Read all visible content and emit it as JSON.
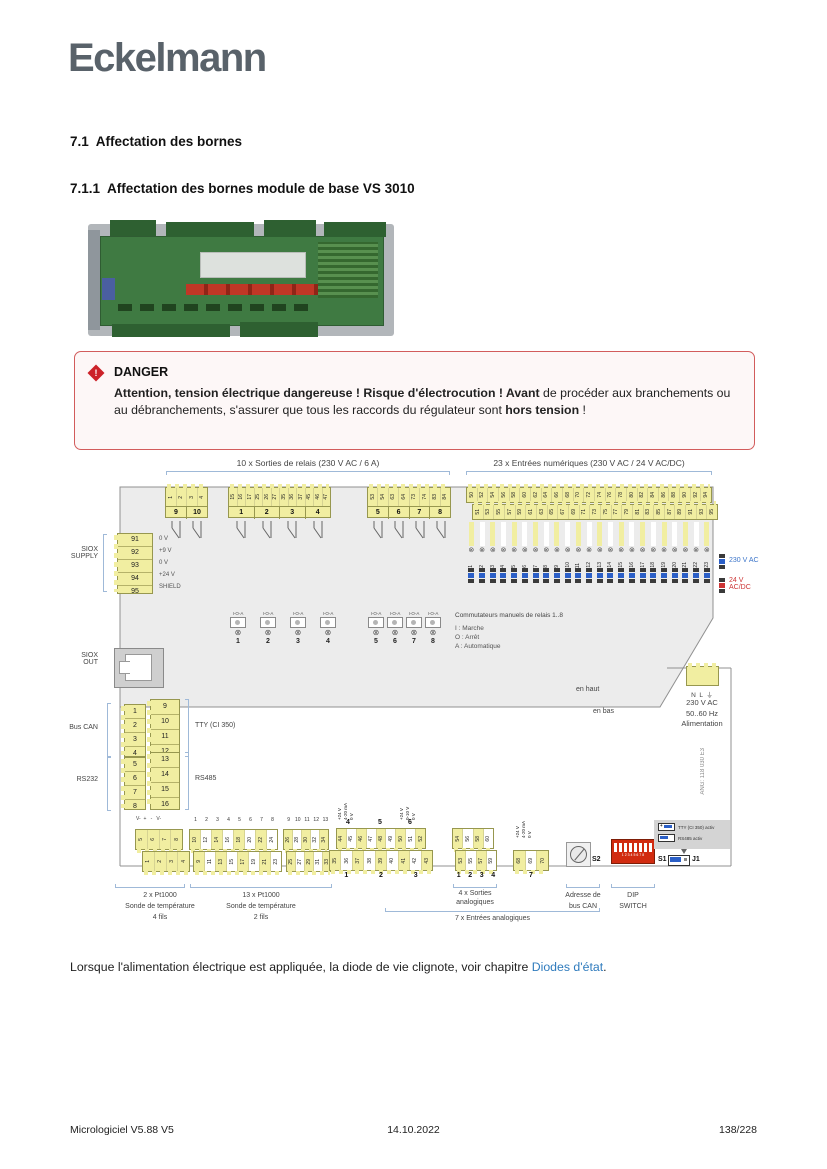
{
  "logo": "Eckelmann",
  "headings": {
    "h1": "7.1  Affectation des bornes",
    "h2": "7.1.1  Affectation des bornes module de base VS 3010"
  },
  "danger": {
    "title": "DANGER",
    "bold1": "Attention, tension électrique dangereuse ! Risque d'électrocution ! Avant",
    "text1": " de procéder aux branchements ou au débranchements, s'assurer que tous les raccords du régulateur sont ",
    "bold2": "hors tension",
    "text2": " !"
  },
  "note": {
    "text": "Lorsque l'alimentation électrique est appliquée, la diode de vie clignote, voir chapitre ",
    "link": "Diodes d'état",
    "after": "."
  },
  "footer": {
    "left": "Micrologiciel V5.88 V5",
    "center": "14.10.2022",
    "right": "138/228"
  },
  "diagram": {
    "relay_section": "10 x Sorties de relais (230 V AC / 6 A)",
    "digital_section": "23 x Entrées numériques (230 V AC / 24 V AC/DC)",
    "relay_blocks": [
      {
        "terminals": [
          "1",
          "2",
          "3",
          "4"
        ],
        "groups": [
          "9",
          "10"
        ]
      },
      {
        "terminals": [
          "15",
          "16",
          "17",
          "25",
          "26",
          "27",
          "35",
          "36",
          "37",
          "45",
          "46",
          "47"
        ],
        "groups": [
          "1",
          "2",
          "3",
          "4"
        ]
      },
      {
        "terminals": [
          "53",
          "54",
          "63",
          "64",
          "73",
          "74",
          "83",
          "84"
        ],
        "groups": [
          "5",
          "6",
          "7",
          "8"
        ]
      }
    ],
    "digital_top": [
      "50",
      "52",
      "54",
      "56",
      "58",
      "60",
      "62",
      "64",
      "66",
      "68",
      "70",
      "72",
      "74",
      "76",
      "78",
      "80",
      "82",
      "84",
      "86",
      "88",
      "90",
      "92",
      "94"
    ],
    "digital_bottom": [
      "51",
      "53",
      "55",
      "57",
      "59",
      "61",
      "63",
      "65",
      "67",
      "69",
      "71",
      "73",
      "75",
      "77",
      "79",
      "81",
      "83",
      "85",
      "87",
      "89",
      "91",
      "93",
      "95"
    ],
    "digital_channels": [
      "1",
      "2",
      "3",
      "4",
      "5",
      "6",
      "7",
      "8",
      "9",
      "10",
      "11",
      "12",
      "13",
      "14",
      "15",
      "16",
      "17",
      "18",
      "19",
      "20",
      "21",
      "22",
      "23"
    ],
    "volt230": "230 V AC",
    "volt24a": "24 V",
    "volt24b": "AC/DC",
    "siox_supply_label1": "SIOX",
    "siox_supply_label2": "SUPPLY",
    "siox_supply": [
      {
        "no": "91",
        "label": "0 V"
      },
      {
        "no": "92",
        "label": "+9 V"
      },
      {
        "no": "93",
        "label": "0 V"
      },
      {
        "no": "94",
        "label": "+24 V"
      },
      {
        "no": "95",
        "label": "SHIELD"
      }
    ],
    "siox_supply_nos": [
      "91",
      "92",
      "93",
      "94",
      "95"
    ],
    "siox_supply_pins": [
      "0 V",
      "+9 V",
      "0 V",
      "+24 V",
      "SHIELD"
    ],
    "siox_out_label1": "SIOX",
    "siox_out_label2": "OUT",
    "switch_mode": "I-O-A",
    "switches_a": [
      "1",
      "2",
      "3",
      "4"
    ],
    "switches_b": [
      "5",
      "6",
      "7",
      "8"
    ],
    "switch_legend_title": "Commutateurs manuels de relais 1..8",
    "switch_legend": [
      "I : Marche",
      "O : Arrêt",
      "A : Automatique"
    ],
    "en_haut": "en haut",
    "en_bas": "en bas",
    "power_pins": "N  L  ⏚",
    "power_lines": [
      "230 V AC",
      "50..60 Hz",
      "Alimentation"
    ],
    "part_no": "ANG: 118 030 E3",
    "bus_can": "Bus CAN",
    "tty": "TTY (CI 350)",
    "rs232": "RS232",
    "rs485": "RS485",
    "can_terms": [
      "1",
      "2",
      "3",
      "4"
    ],
    "tty_terms": [
      "9",
      "10",
      "11",
      "12"
    ],
    "rs232_terms": [
      "5",
      "6",
      "7",
      "8"
    ],
    "rs485_terms": [
      "13",
      "14",
      "15",
      "16"
    ],
    "pt4_header": "V-  +   -   V-",
    "pt4_top": [
      "5",
      "6",
      "7",
      "8"
    ],
    "pt4_bottom": [
      "1",
      "2",
      "3",
      "4"
    ],
    "pt4_label": [
      "2 x Pt1000",
      "Sonde de température",
      "4 fils"
    ],
    "pt2_idx_a": [
      "1",
      "2",
      "3",
      "4",
      "5",
      "6",
      "7",
      "8"
    ],
    "pt2_idx_b": [
      "9",
      "10",
      "11",
      "12",
      "13"
    ],
    "pt2_top_a": [
      "10",
      "12",
      "14",
      "16",
      "18",
      "20",
      "22",
      "24"
    ],
    "pt2_bot_a": [
      "9",
      "11",
      "13",
      "15",
      "17",
      "19",
      "21",
      "23"
    ],
    "pt2_top_b": [
      "26",
      "28",
      "30",
      "32",
      "34"
    ],
    "pt2_bot_b": [
      "25",
      "27",
      "29",
      "31",
      "33"
    ],
    "pt2_label": [
      "13 x Pt1000",
      "Sonde de température",
      "2 fils"
    ],
    "ain_pins_4": [
      "+24 V",
      "4-20 mA",
      "0 V"
    ],
    "ain_no_4": "4",
    "ain_no_5": "5",
    "ain_pins_6": [
      "+24 V",
      "0-10 V",
      "0 V"
    ],
    "ain_no_6": "6",
    "ain_top": [
      "44",
      "45",
      "46",
      "47",
      "48",
      "49",
      "50",
      "51",
      "52"
    ],
    "ain_bottom": [
      "35",
      "36",
      "37",
      "38",
      "39",
      "40",
      "41",
      "42",
      "43"
    ],
    "ain_groups": [
      "1",
      "2",
      "3"
    ],
    "aout_top": [
      "54",
      "56",
      "58",
      "60"
    ],
    "aout_bottom": [
      "53",
      "55",
      "57",
      "59"
    ],
    "aout_numbers": [
      "1",
      "2",
      "3",
      "4"
    ],
    "aout_label": [
      "4 x Sorties",
      "analogiques"
    ],
    "ain7_pins": [
      "+24 V",
      "4-20 mA",
      "0 V"
    ],
    "ain7_terms": [
      "68",
      "69",
      "70"
    ],
    "ain7_no": "7",
    "ain_section": "7 x Entrées analogiques",
    "s2": "S2",
    "s1": "S1",
    "j1": "J1",
    "dip_numbers": "1 2 3 4 5 6 7 8",
    "addr_label": [
      "Adresse de",
      "bus CAN"
    ],
    "dip_label": [
      "DIP",
      "SWITCH"
    ],
    "jumper_tty": "TTY (CI 350) activ",
    "jumper_rs485": "RS485 activ"
  },
  "colors": {
    "accent_blue": "#3b74c9",
    "accent_red": "#cc3333",
    "terminal_yellow": "#f1eea1",
    "danger_red": "#cc2229",
    "link_blue": "#2f7bbd",
    "logo_gray": "#59626a"
  }
}
